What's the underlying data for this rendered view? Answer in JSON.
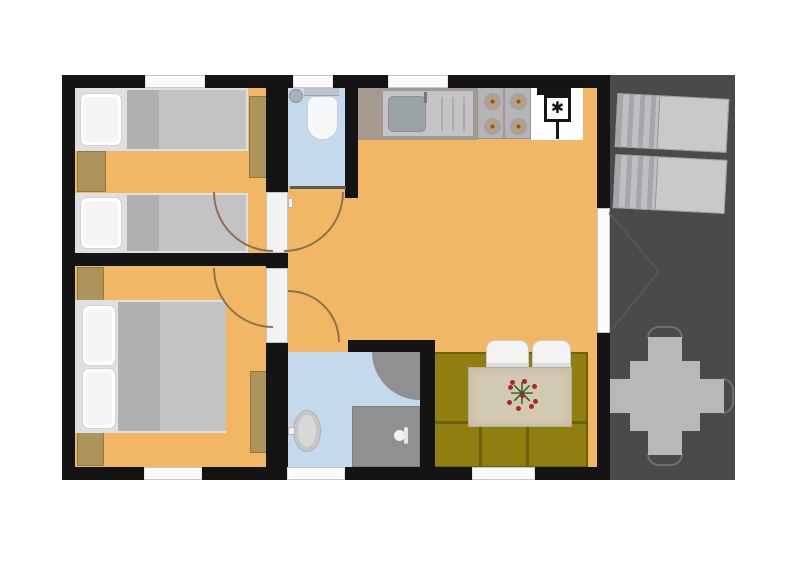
{
  "meta": {
    "image_type": "2D floor plan of a small cabin / holiday home with attached deck",
    "visible_text": "none"
  },
  "palette": {
    "background": "#ffffff",
    "wall": "#141414",
    "floor_wood_orange": "#f2b765",
    "floor_tile_blue": "#c5d9ec",
    "deck_gray": "#4a4a4a",
    "sofa_olive": "#8f7f11",
    "furniture_wood": "#ad945c",
    "counter_top": "#a69a8e",
    "lounger_gray": "#c9c9cb",
    "outdoor_furniture_gray": "#b8b8b8",
    "door_swing_arc": "#8a7250",
    "shower_gray": "#909090",
    "dining_table_beige": "#d2c9b3"
  },
  "symbols": {
    "fridge_star": "✱",
    "flower_centerpiece": "✳"
  },
  "rooms": [
    {
      "id": "bedroom-1",
      "position": "top-left",
      "floor": "orange wood",
      "furniture": [
        "single bed with pillow",
        "single bed with pillow",
        "nightstand between beds",
        "dresser on right wall"
      ],
      "openings": [
        "window top wall",
        "door to living room"
      ]
    },
    {
      "id": "bedroom-2",
      "position": "bottom-left",
      "floor": "orange wood",
      "furniture": [
        "double bed with two pillows",
        "nightstand top-left",
        "nightstand bottom-left",
        "dresser on right wall"
      ],
      "openings": [
        "window bottom wall",
        "door to living room"
      ]
    },
    {
      "id": "wc",
      "position": "top-middle",
      "floor": "blue tile",
      "furniture": [
        "toilet with tank",
        "corner washbasin"
      ],
      "openings": [
        "window top wall",
        "door to living room"
      ]
    },
    {
      "id": "bathroom",
      "position": "bottom-middle",
      "floor": "blue tile",
      "furniture": [
        "oval washbasin with tap",
        "corner shower quarter-circle",
        "shower tray with shower head"
      ],
      "openings": [
        "window bottom wall",
        "door to living room"
      ]
    },
    {
      "id": "kitchen-living-room",
      "position": "center-right",
      "floor": "orange wood",
      "furniture": [
        "kitchen counter",
        "sink with drainboard",
        "four-burner stove",
        "fridge with freezer star symbol",
        "chimney flue",
        "olive three-seat sofa",
        "beige dining table with flower centerpiece",
        "two white chairs"
      ],
      "openings": [
        "window top wall",
        "window bottom wall",
        "french double door to deck"
      ]
    },
    {
      "id": "deck",
      "position": "right",
      "floor": "dark gray decking",
      "furniture": [
        "sun lounger",
        "sun lounger",
        "square outdoor table",
        "four outdoor chairs"
      ]
    }
  ]
}
